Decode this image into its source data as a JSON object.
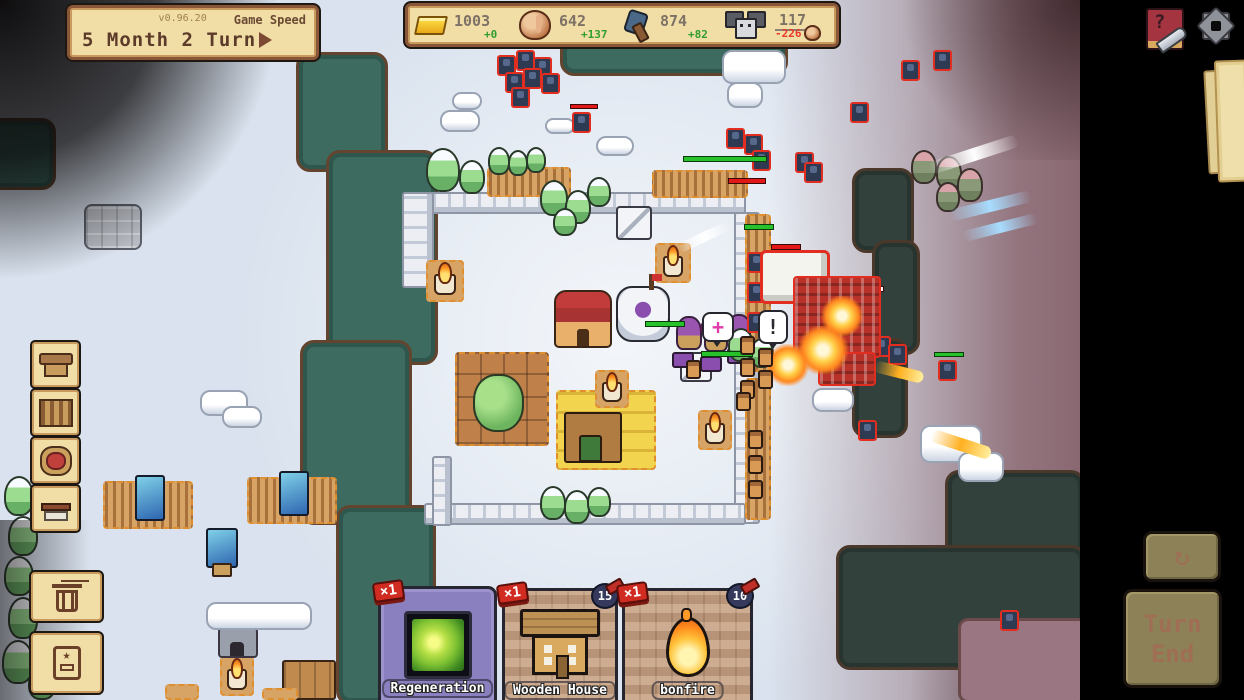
{
  "colors": {
    "ui_cream": "#f1dda6",
    "ui_brown": "#8a5638",
    "positive": "#2f9e2f",
    "negative": "#e8392a",
    "enemy_red": "#e12e20",
    "card_purple": "#8b80bf"
  },
  "meta": {
    "version": "v0.96.20",
    "game_speed_label": "Game Speed",
    "turn_label": "5 Month 2 Turn"
  },
  "resources": {
    "gold": {
      "value": "1003",
      "delta": "+0"
    },
    "food": {
      "value": "642",
      "delta": "+137"
    },
    "materials": {
      "value": "874",
      "delta": "+82"
    },
    "population": {
      "value": "117",
      "delta": "-226"
    }
  },
  "sidebar": {
    "categories": [
      {
        "name": "housing"
      },
      {
        "name": "farming"
      },
      {
        "name": "town-hall"
      },
      {
        "name": "crafting"
      }
    ]
  },
  "cards": [
    {
      "name": "Regeneration",
      "count": "×1",
      "cost": ""
    },
    {
      "name": "Wooden House",
      "count": "×1",
      "cost": "15"
    },
    {
      "name": "bonfire",
      "count": "×1",
      "cost": "10"
    }
  ],
  "turn_controls": {
    "refresh_icon": "↻",
    "end_line1": "Turn",
    "end_line2": "End"
  },
  "help": {
    "question": "?"
  },
  "deck": {
    "star": "★"
  },
  "map": {
    "bubbles": {
      "heal": "+",
      "alert": "!"
    },
    "sprites": [
      {
        "t": "river",
        "x": 560,
        "y": 36,
        "w": 228,
        "h": 40
      },
      {
        "t": "river",
        "x": 296,
        "y": 52,
        "w": 92,
        "h": 120
      },
      {
        "t": "river",
        "x": 326,
        "y": 150,
        "w": 112,
        "h": 215
      },
      {
        "t": "river",
        "x": 300,
        "y": 340,
        "w": 112,
        "h": 185
      },
      {
        "t": "river",
        "x": 336,
        "y": 505,
        "w": 100,
        "h": 200
      },
      {
        "t": "river",
        "x": -24,
        "y": 118,
        "w": 80,
        "h": 72
      },
      {
        "t": "riverd",
        "x": 852,
        "y": 168,
        "w": 62,
        "h": 85
      },
      {
        "t": "riverd",
        "x": 872,
        "y": 240,
        "w": 48,
        "h": 115
      },
      {
        "t": "riverd",
        "x": 852,
        "y": 338,
        "w": 56,
        "h": 100
      },
      {
        "t": "riverd",
        "x": 945,
        "y": 470,
        "w": 140,
        "h": 100
      },
      {
        "t": "riverd",
        "x": 836,
        "y": 545,
        "w": 250,
        "h": 125
      },
      {
        "t": "mauveland",
        "x": 958,
        "y": 618,
        "w": 130,
        "h": 85
      },
      {
        "t": "wallh",
        "x": 404,
        "y": 192,
        "w": 342,
        "h": 22
      },
      {
        "t": "wallv",
        "x": 402,
        "y": 192,
        "w": 32,
        "h": 96
      },
      {
        "t": "wallv",
        "x": 734,
        "y": 212,
        "w": 26,
        "h": 312
      },
      {
        "t": "wallh",
        "x": 424,
        "y": 503,
        "w": 322,
        "h": 22
      },
      {
        "t": "wallv",
        "x": 432,
        "y": 456,
        "w": 20,
        "h": 70
      },
      {
        "t": "farm",
        "x": 487,
        "y": 167,
        "w": 84,
        "h": 30
      },
      {
        "t": "farm",
        "x": 652,
        "y": 170,
        "w": 96,
        "h": 28
      },
      {
        "t": "farm",
        "x": 745,
        "y": 214,
        "w": 26,
        "h": 158
      },
      {
        "t": "farm",
        "x": 745,
        "y": 378,
        "w": 26,
        "h": 142
      },
      {
        "t": "orchard",
        "x": 455,
        "y": 352,
        "w": 94,
        "h": 94
      },
      {
        "t": "wheatfarm",
        "x": 556,
        "y": 390,
        "w": 100,
        "h": 80
      },
      {
        "t": "fishery",
        "x": 103,
        "y": 481,
        "w": 90,
        "h": 48
      },
      {
        "t": "fishery",
        "x": 247,
        "y": 477,
        "w": 90,
        "h": 47
      },
      {
        "t": "fishstand",
        "x": 206,
        "y": 528,
        "w": 32,
        "h": 40
      },
      {
        "t": "bonfire",
        "x": 426,
        "y": 260,
        "w": 38,
        "h": 42
      },
      {
        "t": "bonfire",
        "x": 655,
        "y": 243,
        "w": 36,
        "h": 40
      },
      {
        "t": "bonfire",
        "x": 595,
        "y": 370,
        "w": 34,
        "h": 38
      },
      {
        "t": "bonfire",
        "x": 698,
        "y": 410,
        "w": 34,
        "h": 40
      },
      {
        "t": "bonfire",
        "x": 220,
        "y": 656,
        "w": 34,
        "h": 40
      },
      {
        "t": "tent",
        "x": 616,
        "y": 206,
        "w": 36,
        "h": 34
      },
      {
        "t": "tent",
        "x": 680,
        "y": 352,
        "w": 32,
        "h": 30
      },
      {
        "t": "mine",
        "x": 218,
        "y": 622,
        "w": 40,
        "h": 36
      },
      {
        "t": "crates",
        "x": 282,
        "y": 660,
        "w": 54,
        "h": 40
      },
      {
        "t": "plat",
        "x": 165,
        "y": 684,
        "w": 34,
        "h": 16
      },
      {
        "t": "plat",
        "x": 262,
        "y": 688,
        "w": 36,
        "h": 12
      },
      {
        "t": "inn",
        "x": 554,
        "y": 290,
        "w": 58,
        "h": 58
      },
      {
        "t": "dome",
        "x": 616,
        "y": 286,
        "w": 54,
        "h": 56
      },
      {
        "t": "purp",
        "x": 676,
        "y": 316,
        "w": 26,
        "h": 34
      },
      {
        "t": "purp",
        "x": 704,
        "y": 322,
        "w": 24,
        "h": 30
      },
      {
        "t": "purp",
        "x": 727,
        "y": 314,
        "w": 24,
        "h": 30
      },
      {
        "t": "ptable",
        "x": 672,
        "y": 352,
        "w": 22,
        "h": 16
      },
      {
        "t": "ptable",
        "x": 700,
        "y": 356,
        "w": 22,
        "h": 16
      },
      {
        "t": "ptable",
        "x": 727,
        "y": 348,
        "w": 22,
        "h": 16
      },
      {
        "t": "tree",
        "x": 426,
        "y": 148,
        "w": 34,
        "h": 44
      },
      {
        "t": "tree",
        "x": 459,
        "y": 160,
        "w": 26,
        "h": 34
      },
      {
        "t": "tree",
        "x": 488,
        "y": 147,
        "w": 22,
        "h": 28
      },
      {
        "t": "tree",
        "x": 508,
        "y": 150,
        "w": 20,
        "h": 26
      },
      {
        "t": "tree",
        "x": 526,
        "y": 147,
        "w": 20,
        "h": 26
      },
      {
        "t": "tree",
        "x": 540,
        "y": 180,
        "w": 28,
        "h": 36
      },
      {
        "t": "tree",
        "x": 565,
        "y": 190,
        "w": 26,
        "h": 34
      },
      {
        "t": "tree",
        "x": 587,
        "y": 177,
        "w": 24,
        "h": 30
      },
      {
        "t": "tree",
        "x": 553,
        "y": 208,
        "w": 24,
        "h": 28
      },
      {
        "t": "tree",
        "x": 4,
        "y": 476,
        "w": 30,
        "h": 40
      },
      {
        "t": "tree",
        "x": 8,
        "y": 516,
        "w": 30,
        "h": 40
      },
      {
        "t": "tree",
        "x": 4,
        "y": 556,
        "w": 30,
        "h": 40
      },
      {
        "t": "tree",
        "x": 8,
        "y": 597,
        "w": 30,
        "h": 42
      },
      {
        "t": "tree",
        "x": 2,
        "y": 640,
        "w": 32,
        "h": 44
      },
      {
        "t": "tree",
        "x": 28,
        "y": 668,
        "w": 28,
        "h": 32
      },
      {
        "t": "tree",
        "x": 540,
        "y": 486,
        "w": 26,
        "h": 34
      },
      {
        "t": "tree",
        "x": 564,
        "y": 490,
        "w": 26,
        "h": 34
      },
      {
        "t": "tree",
        "x": 587,
        "y": 487,
        "w": 24,
        "h": 30
      },
      {
        "t": "tree",
        "x": 728,
        "y": 328,
        "w": 26,
        "h": 34
      },
      {
        "t": "tree",
        "x": 750,
        "y": 338,
        "w": 24,
        "h": 30
      },
      {
        "t": "mtree",
        "x": 911,
        "y": 150,
        "w": 26,
        "h": 34
      },
      {
        "t": "mtree",
        "x": 936,
        "y": 156,
        "w": 26,
        "h": 34
      },
      {
        "t": "mtree",
        "x": 957,
        "y": 168,
        "w": 26,
        "h": 34
      },
      {
        "t": "mtree",
        "x": 936,
        "y": 182,
        "w": 24,
        "h": 30
      },
      {
        "t": "snow",
        "x": 722,
        "y": 50,
        "w": 64,
        "h": 34
      },
      {
        "t": "snow",
        "x": 727,
        "y": 82,
        "w": 36,
        "h": 26
      },
      {
        "t": "snow",
        "x": 596,
        "y": 136,
        "w": 38,
        "h": 20
      },
      {
        "t": "snow",
        "x": 545,
        "y": 118,
        "w": 30,
        "h": 16
      },
      {
        "t": "snow",
        "x": 440,
        "y": 110,
        "w": 40,
        "h": 22
      },
      {
        "t": "snow",
        "x": 452,
        "y": 92,
        "w": 30,
        "h": 18
      },
      {
        "t": "snow",
        "x": 200,
        "y": 390,
        "w": 48,
        "h": 26
      },
      {
        "t": "snow",
        "x": 222,
        "y": 406,
        "w": 40,
        "h": 22
      },
      {
        "t": "snow",
        "x": 206,
        "y": 602,
        "w": 106,
        "h": 28
      },
      {
        "t": "snow",
        "x": 920,
        "y": 425,
        "w": 62,
        "h": 38
      },
      {
        "t": "snow",
        "x": 958,
        "y": 452,
        "w": 46,
        "h": 30
      },
      {
        "t": "snow",
        "x": 812,
        "y": 388,
        "w": 42,
        "h": 24
      },
      {
        "t": "rocks",
        "x": 84,
        "y": 204,
        "w": 58,
        "h": 46
      },
      {
        "t": "enemy",
        "x": 497,
        "y": 55
      },
      {
        "t": "enemy",
        "x": 516,
        "y": 50
      },
      {
        "t": "enemy",
        "x": 533,
        "y": 57
      },
      {
        "t": "enemy",
        "x": 505,
        "y": 72
      },
      {
        "t": "enemy",
        "x": 523,
        "y": 68
      },
      {
        "t": "enemy",
        "x": 541,
        "y": 73
      },
      {
        "t": "enemy",
        "x": 511,
        "y": 87
      },
      {
        "t": "enemy",
        "x": 572,
        "y": 112
      },
      {
        "t": "hpr",
        "x": 570,
        "y": 104,
        "w": 28,
        "h": 5
      },
      {
        "t": "enemy",
        "x": 726,
        "y": 128
      },
      {
        "t": "enemy",
        "x": 744,
        "y": 134
      },
      {
        "t": "enemy",
        "x": 752,
        "y": 150
      },
      {
        "t": "enemy",
        "x": 795,
        "y": 152
      },
      {
        "t": "enemy",
        "x": 804,
        "y": 162
      },
      {
        "t": "enemy",
        "x": 901,
        "y": 60
      },
      {
        "t": "enemy",
        "x": 850,
        "y": 102
      },
      {
        "t": "enemy",
        "x": 933,
        "y": 50
      },
      {
        "t": "enemy",
        "x": 938,
        "y": 360
      },
      {
        "t": "hpg",
        "x": 934,
        "y": 352,
        "w": 30,
        "h": 5
      },
      {
        "t": "enemy",
        "x": 858,
        "y": 420
      },
      {
        "t": "enemy",
        "x": 1000,
        "y": 610
      },
      {
        "t": "enemy",
        "x": 872,
        "y": 336
      },
      {
        "t": "enemy",
        "x": 888,
        "y": 344
      },
      {
        "t": "enemy",
        "x": 747,
        "y": 252
      },
      {
        "t": "enemy",
        "x": 747,
        "y": 282
      },
      {
        "t": "enemy",
        "x": 747,
        "y": 312
      },
      {
        "t": "hpg",
        "x": 683,
        "y": 156,
        "w": 84,
        "h": 6
      },
      {
        "t": "hpr",
        "x": 728,
        "y": 178,
        "w": 38,
        "h": 6
      },
      {
        "t": "hpg",
        "x": 744,
        "y": 224,
        "w": 30,
        "h": 6
      },
      {
        "t": "hpmix",
        "x": 842,
        "y": 286,
        "w": 42,
        "h": 6
      },
      {
        "t": "hpg",
        "x": 798,
        "y": 301,
        "w": 34,
        "h": 6
      },
      {
        "t": "hpg",
        "x": 645,
        "y": 321,
        "w": 40,
        "h": 6
      },
      {
        "t": "hpg",
        "x": 701,
        "y": 351,
        "w": 52,
        "h": 6
      },
      {
        "t": "hpr",
        "x": 771,
        "y": 244,
        "w": 30,
        "h": 6
      },
      {
        "t": "boss",
        "x": 760,
        "y": 250,
        "w": 70,
        "h": 54
      },
      {
        "t": "redcluster",
        "x": 793,
        "y": 276,
        "w": 88,
        "h": 82
      },
      {
        "t": "redcluster",
        "x": 818,
        "y": 352,
        "w": 58,
        "h": 34
      },
      {
        "t": "boom",
        "x": 820,
        "y": 296,
        "w": 44,
        "h": 40
      },
      {
        "t": "boom",
        "x": 796,
        "y": 326,
        "w": 54,
        "h": 48
      },
      {
        "t": "boom",
        "x": 766,
        "y": 344,
        "w": 44,
        "h": 42
      },
      {
        "t": "beamw",
        "x": 928,
        "y": 148,
        "w": 92,
        "h": 13,
        "r": -18
      },
      {
        "t": "beamw",
        "x": 676,
        "y": 232,
        "w": 56,
        "h": 10,
        "r": -25
      },
      {
        "t": "beamb",
        "x": 948,
        "y": 200,
        "w": 84,
        "h": 12,
        "r": -14
      },
      {
        "t": "beamb",
        "x": 962,
        "y": 222,
        "w": 76,
        "h": 11,
        "r": -14
      },
      {
        "t": "fireb",
        "x": 874,
        "y": 366,
        "w": 50,
        "h": 12,
        "r": 14
      },
      {
        "t": "fireb",
        "x": 930,
        "y": 438,
        "w": 62,
        "h": 13,
        "r": 18
      },
      {
        "t": "defender",
        "x": 740,
        "y": 336
      },
      {
        "t": "defender",
        "x": 740,
        "y": 358
      },
      {
        "t": "defender",
        "x": 740,
        "y": 380
      },
      {
        "t": "defender",
        "x": 758,
        "y": 348
      },
      {
        "t": "defender",
        "x": 758,
        "y": 370
      },
      {
        "t": "defender",
        "x": 686,
        "y": 360
      },
      {
        "t": "defender",
        "x": 736,
        "y": 392
      },
      {
        "t": "defender",
        "x": 748,
        "y": 430
      },
      {
        "t": "defender",
        "x": 748,
        "y": 455
      },
      {
        "t": "defender",
        "x": 748,
        "y": 480
      },
      {
        "t": "pmage",
        "x": 700,
        "y": 320,
        "w": 16,
        "h": 16
      }
    ]
  }
}
